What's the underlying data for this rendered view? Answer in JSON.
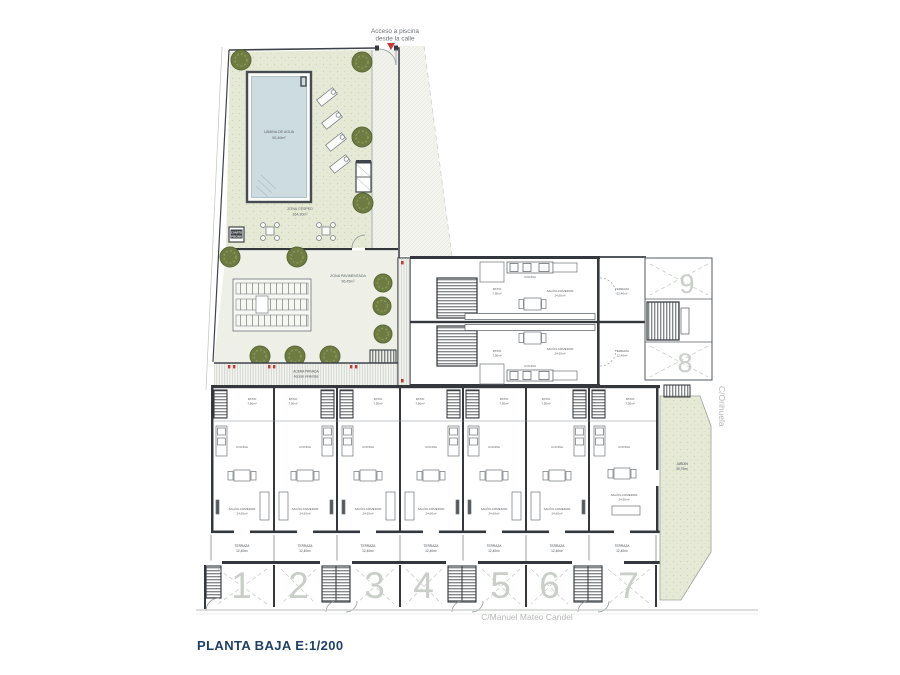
{
  "title": "PLANTA BAJA  E:1/200",
  "annotations": {
    "access_line1": "Acceso a piscina",
    "access_line2": "desde la calle",
    "street_bottom": "C/Manuel Mateo Candel",
    "street_right": "C/Orihuela"
  },
  "zones": {
    "pool": {
      "line1": "LÁMINA DE AGUA",
      "line2": "50,40m²"
    },
    "lawn": {
      "line1": "ZONA CÉSPED",
      "line2": "164,30m²"
    },
    "paved": {
      "line1": "ZONA PAVIMENTADA",
      "line2": "96,45m²"
    },
    "walkway": {
      "line1": "ACERA PRIVADA",
      "line2": "Acceso viviendas"
    },
    "pool_room": {
      "line1": "CUARTO",
      "line2": "PISCINA"
    },
    "garden": {
      "line1": "JARDÍN",
      "line2": "39,75m²"
    }
  },
  "room_labels": {
    "patio": {
      "line1": "PATIO",
      "line2": "7,50m²"
    },
    "salon": {
      "line1": "SALÓN-COMEDOR",
      "line2": "24,60m²"
    },
    "terraza": {
      "line1": "TERRAZA",
      "line2": "12,40m²"
    },
    "cocina": {
      "line1": "COCINA"
    }
  },
  "units": {
    "row_numbers": [
      "1",
      "2",
      "3",
      "4",
      "5",
      "6",
      "7"
    ],
    "upper_numbers": [
      "8",
      "9"
    ]
  },
  "colors": {
    "wall": "#34383d",
    "lawn_green": "#e5e9d6",
    "pool_water": "#ccdce1",
    "tree_green": "#6e7c42",
    "accent_red": "#c43b33",
    "unit_number_gray": "#c9cec9",
    "title_navy": "#1f4066"
  }
}
